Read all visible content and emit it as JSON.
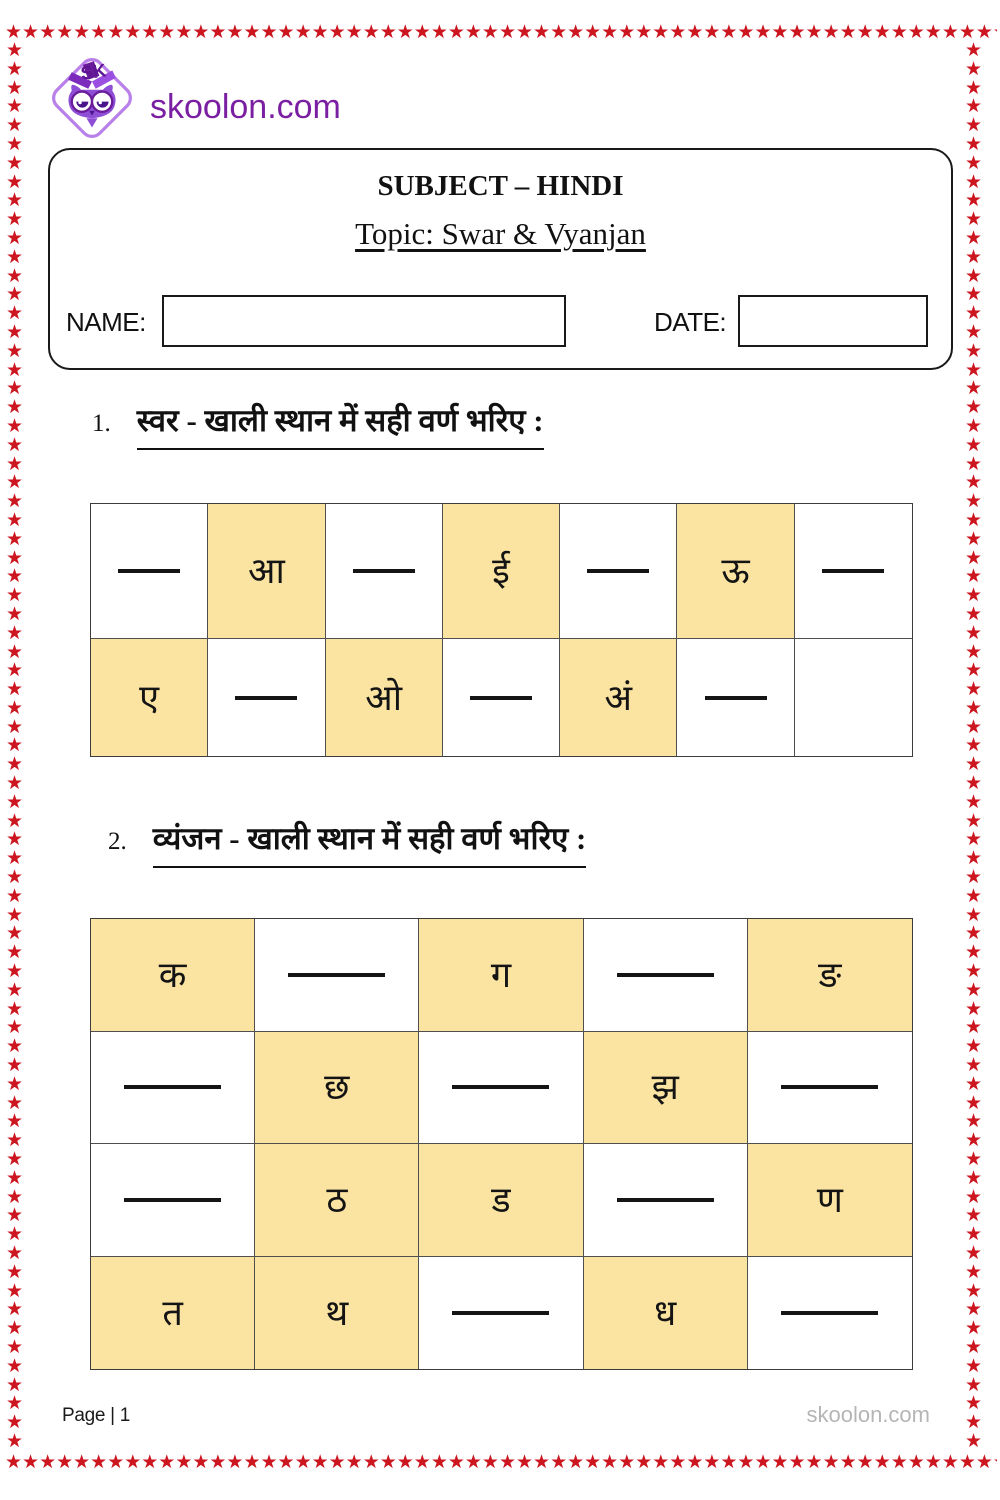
{
  "border": {
    "star": "★",
    "color": "#cc1620"
  },
  "logo": {
    "site": "skoolon.com",
    "icon": "owl-diamond-logo"
  },
  "header": {
    "subject": "SUBJECT – HINDI",
    "topic": "Topic: Swar & Vyanjan",
    "name_label": "NAME:",
    "name_value": "",
    "date_label": "DATE:",
    "date_value": ""
  },
  "sections": {
    "swar": {
      "number": "1.",
      "heading": "स्वर - खाली स्थान में सही वर्ण भरिए :"
    },
    "vyanjan": {
      "number": "2.",
      "heading": "व्यंजन - खाली स्थान में सही वर्ण भरिए :"
    }
  },
  "swar_table": {
    "rows": [
      [
        {
          "type": "blank"
        },
        {
          "type": "letter",
          "char": "आ"
        },
        {
          "type": "blank"
        },
        {
          "type": "letter",
          "char": "ई"
        },
        {
          "type": "blank"
        },
        {
          "type": "letter",
          "char": "ऊ"
        },
        {
          "type": "blank"
        }
      ],
      [
        {
          "type": "letter",
          "char": "ए"
        },
        {
          "type": "blank"
        },
        {
          "type": "letter",
          "char": "ओ"
        },
        {
          "type": "blank"
        },
        {
          "type": "letter",
          "char": "अं"
        },
        {
          "type": "blank"
        },
        {
          "type": "empty"
        }
      ]
    ]
  },
  "vyanjan_table": {
    "rows": [
      [
        {
          "type": "letter",
          "char": "क"
        },
        {
          "type": "blank"
        },
        {
          "type": "letter",
          "char": "ग"
        },
        {
          "type": "blank"
        },
        {
          "type": "letter",
          "char": "ङ"
        }
      ],
      [
        {
          "type": "blank"
        },
        {
          "type": "letter",
          "char": "छ"
        },
        {
          "type": "blank"
        },
        {
          "type": "letter",
          "char": "झ"
        },
        {
          "type": "blank"
        }
      ],
      [
        {
          "type": "blank"
        },
        {
          "type": "letter",
          "char": "ठ"
        },
        {
          "type": "letter",
          "char": "ड"
        },
        {
          "type": "blank"
        },
        {
          "type": "letter",
          "char": "ण"
        }
      ],
      [
        {
          "type": "letter",
          "char": "त"
        },
        {
          "type": "letter",
          "char": "थ"
        },
        {
          "type": "blank"
        },
        {
          "type": "letter",
          "char": "ध"
        },
        {
          "type": "blank"
        }
      ]
    ]
  },
  "footer": {
    "page": "Page | 1",
    "site": "skoolon.com"
  },
  "colors": {
    "highlight": "#fbe3a2",
    "star_red": "#cc1620",
    "brand_purple": "#7b1fa2"
  }
}
